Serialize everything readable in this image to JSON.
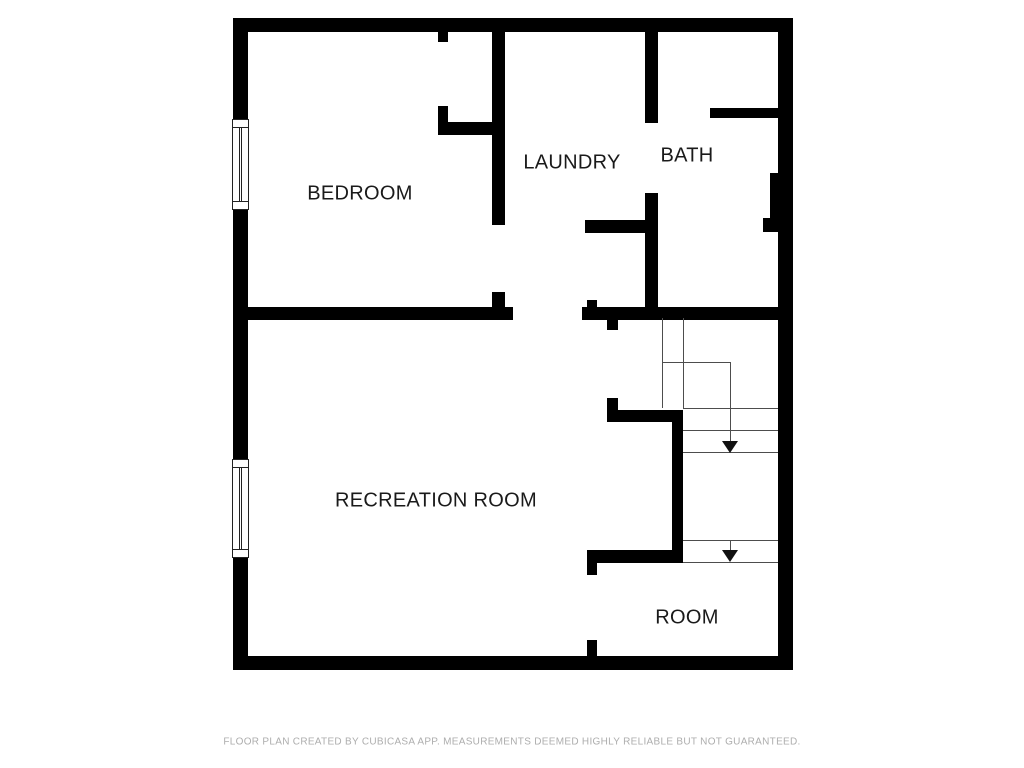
{
  "page": {
    "background": "#ffffff"
  },
  "disclaimer": {
    "text": "FLOOR PLAN CREATED BY CUBICASA APP. MEASUREMENTS DEEMED HIGHLY RELIABLE BUT NOT GUARANTEED.",
    "color": "#adadad"
  },
  "floorplan": {
    "colors": {
      "wall": "#000000",
      "label": "#1a1a1a",
      "stair_line": "#4d4d4d",
      "arrow": "#111111",
      "window_frame": "#222222"
    },
    "rooms": [
      {
        "id": "bedroom",
        "label": "BEDROOM",
        "cx": 360,
        "cy": 194
      },
      {
        "id": "laundry",
        "label": "LAUNDRY",
        "cx": 572,
        "cy": 163
      },
      {
        "id": "bath",
        "label": "BATH",
        "cx": 687,
        "cy": 156
      },
      {
        "id": "recreation-room",
        "label": "RECREATION ROOM",
        "cx": 436,
        "cy": 501
      },
      {
        "id": "room",
        "label": "ROOM",
        "cx": 687,
        "cy": 618
      }
    ],
    "walls": [
      {
        "name": "outer-wall-top",
        "rect": [
          233,
          18,
          560,
          14
        ]
      },
      {
        "name": "outer-wall-bottom",
        "rect": [
          233,
          656,
          560,
          14
        ]
      },
      {
        "name": "outer-wall-left-upper",
        "rect": [
          233,
          18,
          15,
          101
        ]
      },
      {
        "name": "outer-wall-left-middle",
        "rect": [
          233,
          210,
          15,
          249
        ]
      },
      {
        "name": "outer-wall-left-lower",
        "rect": [
          233,
          558,
          15,
          112
        ]
      },
      {
        "name": "outer-wall-right",
        "rect": [
          778,
          18,
          15,
          652
        ]
      },
      {
        "name": "closet-wall-stub-top",
        "rect": [
          438,
          32,
          10,
          10
        ]
      },
      {
        "name": "closet-wall-stub-bottom",
        "rect": [
          438,
          106,
          10,
          16
        ]
      },
      {
        "name": "closet-wall-bottom",
        "rect": [
          438,
          122,
          67,
          13
        ]
      },
      {
        "name": "bedroom-laundry-wall-upper",
        "rect": [
          492,
          32,
          13,
          193
        ]
      },
      {
        "name": "bedroom-laundry-wall-lower",
        "rect": [
          492,
          292,
          13,
          28
        ]
      },
      {
        "name": "main-divider-wall-left",
        "rect": [
          248,
          307,
          265,
          13
        ]
      },
      {
        "name": "main-divider-wall-right",
        "rect": [
          582,
          307,
          196,
          13
        ]
      },
      {
        "name": "laundry-bottom-wall",
        "rect": [
          585,
          220,
          73,
          13
        ]
      },
      {
        "name": "hall-closet-wall-stub",
        "rect": [
          587,
          300,
          10,
          20
        ]
      },
      {
        "name": "bath-wall-upper",
        "rect": [
          645,
          32,
          13,
          91
        ]
      },
      {
        "name": "bath-wall-lower",
        "rect": [
          645,
          193,
          13,
          127
        ]
      },
      {
        "name": "bath-shower-wall",
        "rect": [
          710,
          108,
          68,
          10
        ]
      },
      {
        "name": "bath-duct",
        "rect": [
          770,
          173,
          8,
          59
        ]
      },
      {
        "name": "bath-duct-foot",
        "rect": [
          763,
          218,
          15,
          14
        ]
      },
      {
        "name": "stair-entry-wall-top",
        "rect": [
          607,
          318,
          11,
          12
        ]
      },
      {
        "name": "stair-entry-wall-bottom",
        "rect": [
          607,
          398,
          11,
          22
        ]
      },
      {
        "name": "stair-wall-horizontal",
        "rect": [
          607,
          410,
          76,
          12
        ]
      },
      {
        "name": "stair-wall-vertical",
        "rect": [
          672,
          410,
          11,
          153
        ]
      },
      {
        "name": "room-top-wall",
        "rect": [
          587,
          550,
          96,
          13
        ]
      },
      {
        "name": "room-left-wall-stub-top",
        "rect": [
          587,
          563,
          10,
          12
        ]
      },
      {
        "name": "room-left-wall-stub-bottom",
        "rect": [
          587,
          640,
          10,
          20
        ]
      }
    ],
    "windows": [
      {
        "name": "bedroom-window",
        "rect": [
          232,
          119,
          17,
          91
        ]
      },
      {
        "name": "recreation-room-window",
        "rect": [
          232,
          459,
          17,
          99
        ]
      }
    ],
    "stair_lines": [
      {
        "name": "stair-tread-line",
        "rect": [
          662,
          318,
          1,
          90
        ]
      },
      {
        "name": "stair-tread-line",
        "rect": [
          683,
          318,
          1,
          90
        ]
      },
      {
        "name": "stair-walk-line",
        "rect": [
          662,
          362,
          69,
          1
        ]
      },
      {
        "name": "stair-tread-line",
        "rect": [
          683,
          408,
          95,
          1
        ]
      },
      {
        "name": "stair-tread-line",
        "rect": [
          683,
          430,
          95,
          1
        ]
      },
      {
        "name": "stair-tread-line",
        "rect": [
          683,
          452,
          95,
          1
        ]
      },
      {
        "name": "stair-tread-line",
        "rect": [
          683,
          540,
          95,
          1
        ]
      },
      {
        "name": "stair-tread-line",
        "rect": [
          683,
          562,
          95,
          1
        ]
      }
    ],
    "arrows": [
      {
        "name": "stair-down-arrow-upper",
        "stem": [
          730,
          362,
          80
        ],
        "tip": [
          730,
          453
        ]
      },
      {
        "name": "stair-down-arrow-lower",
        "stem": [
          730,
          540,
          11
        ],
        "tip": [
          730,
          562
        ]
      }
    ]
  }
}
